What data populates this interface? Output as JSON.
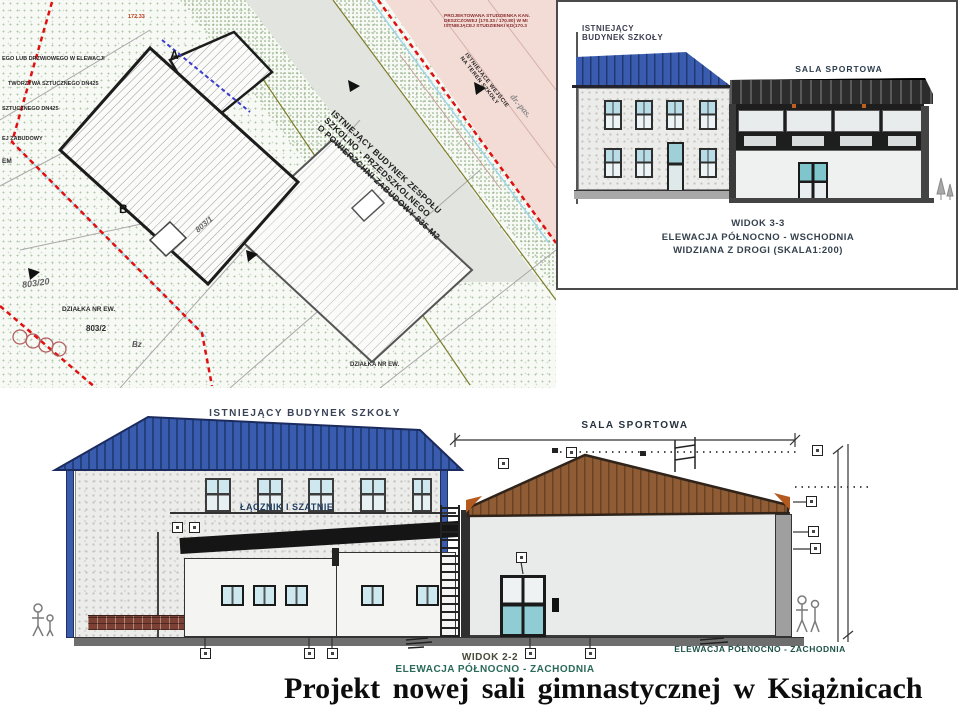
{
  "title": "Projekt nowej sali gimnastycznej w Książnicach",
  "site_plan": {
    "margin_notes": [
      "EGO LUB DRZWIOWEGO W ELEWACJI",
      "TWORZYWA SZTUCZNEGO DN425",
      "SZTUCZNEGO DN425",
      "EJ ZABUDOWY",
      "EM"
    ],
    "spot_elevation": "172.33",
    "marker_a": "A",
    "marker_b": "B",
    "building_label_lines": [
      "ISTNIEJĄCY BUDYNEK ZESPOŁU",
      "SZKOLNO - PRZEDSZKOLNEGO",
      "O POWIERZCHNI ZABUDOWY 835 M2"
    ],
    "parcel_label": "DZIAŁKA NR EW.",
    "parcel_number": "803/2",
    "parcel_number_2": "803/20",
    "parcel_number_3": "803/1",
    "terrain_code": "Bz",
    "bottom_parcel_label": "DZIAŁKA NR EW.",
    "road_label": "dr.-pas.",
    "drain_note_lines": [
      "PROJEKTOWANA STUDZIENKA KAN.",
      "DESZCZOWEJ (170.33 / 170.80) W MI",
      "ISTNIEJĄCEJ STUDZIENKI KD(170.3"
    ],
    "entrance_label_lines": [
      "ISTNIEJĄCE WEJŚCIE",
      "NA TEREN SZKOŁY"
    ]
  },
  "view_3_3": {
    "school_label_lines": [
      "ISTNIEJĄCY",
      "BUDYNEK SZKOŁY"
    ],
    "hall_label": "SALA SPORTOWA",
    "caption_lines": [
      "WIDOK 3-3",
      "ELEWACJA PÓŁNOCNO - WSCHODNIA",
      "WIDZIANA Z DROGI (SKALA1:200)"
    ]
  },
  "view_2_2": {
    "school_label": "ISTNIEJĄCY BUDYNEK SZKOŁY",
    "link_label": "ŁĄCZNIK I SZATNIE",
    "hall_label": "SALA SPORTOWA",
    "side_elevation_label": "ELEWACJA PÓŁNOCNO - ZACHODNIA",
    "caption_lines": [
      "WIDOK 2-2",
      "ELEWACJA PÓŁNOCNO - ZACHODNIA"
    ]
  },
  "colors": {
    "roof_blue": "#3a5cae",
    "roof_brown": "#8f5c35",
    "boundary_red": "#e01010",
    "road_pink": "#f3dbd6",
    "caption_teal": "#2a6a58",
    "glass_blue": "#cfe7ef"
  }
}
